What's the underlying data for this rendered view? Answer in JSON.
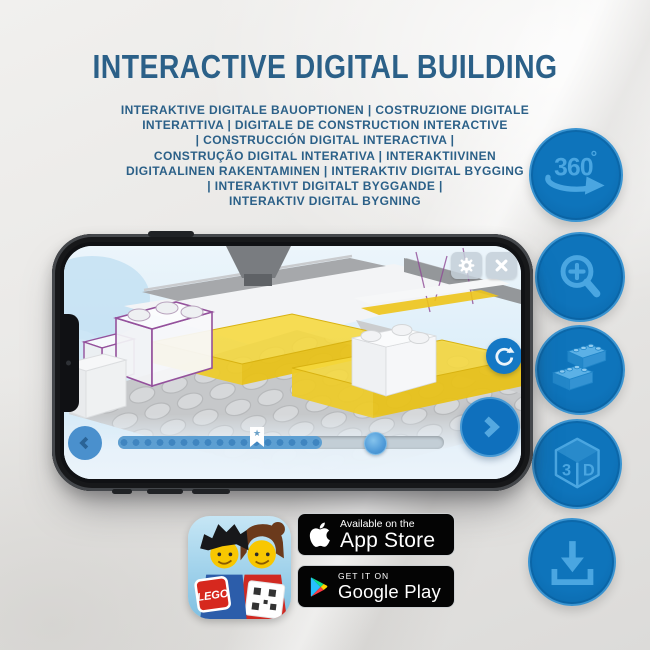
{
  "header": {
    "title": "INTERACTIVE DIGITAL BUILDING"
  },
  "subtitle": {
    "lines": [
      "INTERAKTIVE DIGITALE BAUOPTIONEN | COSTRUZIONE DIGITALE",
      "INTERATTIVA | DIGITALE DE CONSTRUCTION INTERACTIVE",
      "| CONSTRUCCIÓN DIGITAL INTERACTIVA |",
      "CONSTRUÇÃO DIGITAL INTERATIVA | INTERAKTIIVINEN",
      "DIGITAALINEN RAKENTAMINEN | INTERAKTIV DIGITAL BYGGING",
      "| INTERAKTIVT DIGITALT BYGGANDE |",
      "INTERAKTIV DIGITAL BYGNING"
    ]
  },
  "feature_icons": {
    "items": [
      {
        "name": "360-rotation-icon"
      },
      {
        "name": "zoom-in-icon"
      },
      {
        "name": "brick-options-icon"
      },
      {
        "name": "3d-view-icon"
      },
      {
        "name": "download-icon"
      }
    ],
    "rotation_text": "360",
    "rotation_degree": "°",
    "cube_left": "3",
    "cube_right": "D"
  },
  "phone_app": {
    "slider_star": "★"
  },
  "app_icon": {
    "lego_text": "LEGO"
  },
  "badges": {
    "app_store": {
      "top": "Available on the",
      "bottom": "App Store"
    },
    "google_play": {
      "top": "GET IT ON",
      "bottom": "Google Play"
    }
  },
  "colors": {
    "title_blue": "#2b6088",
    "icon_circle_blue": "#0b70b8",
    "icon_glyph_blue": "#4aa6e1",
    "brick_yellow": "#f6d83c",
    "ghost_outline_purple": "#94519c",
    "ui_button_blue": "#1478c5"
  }
}
